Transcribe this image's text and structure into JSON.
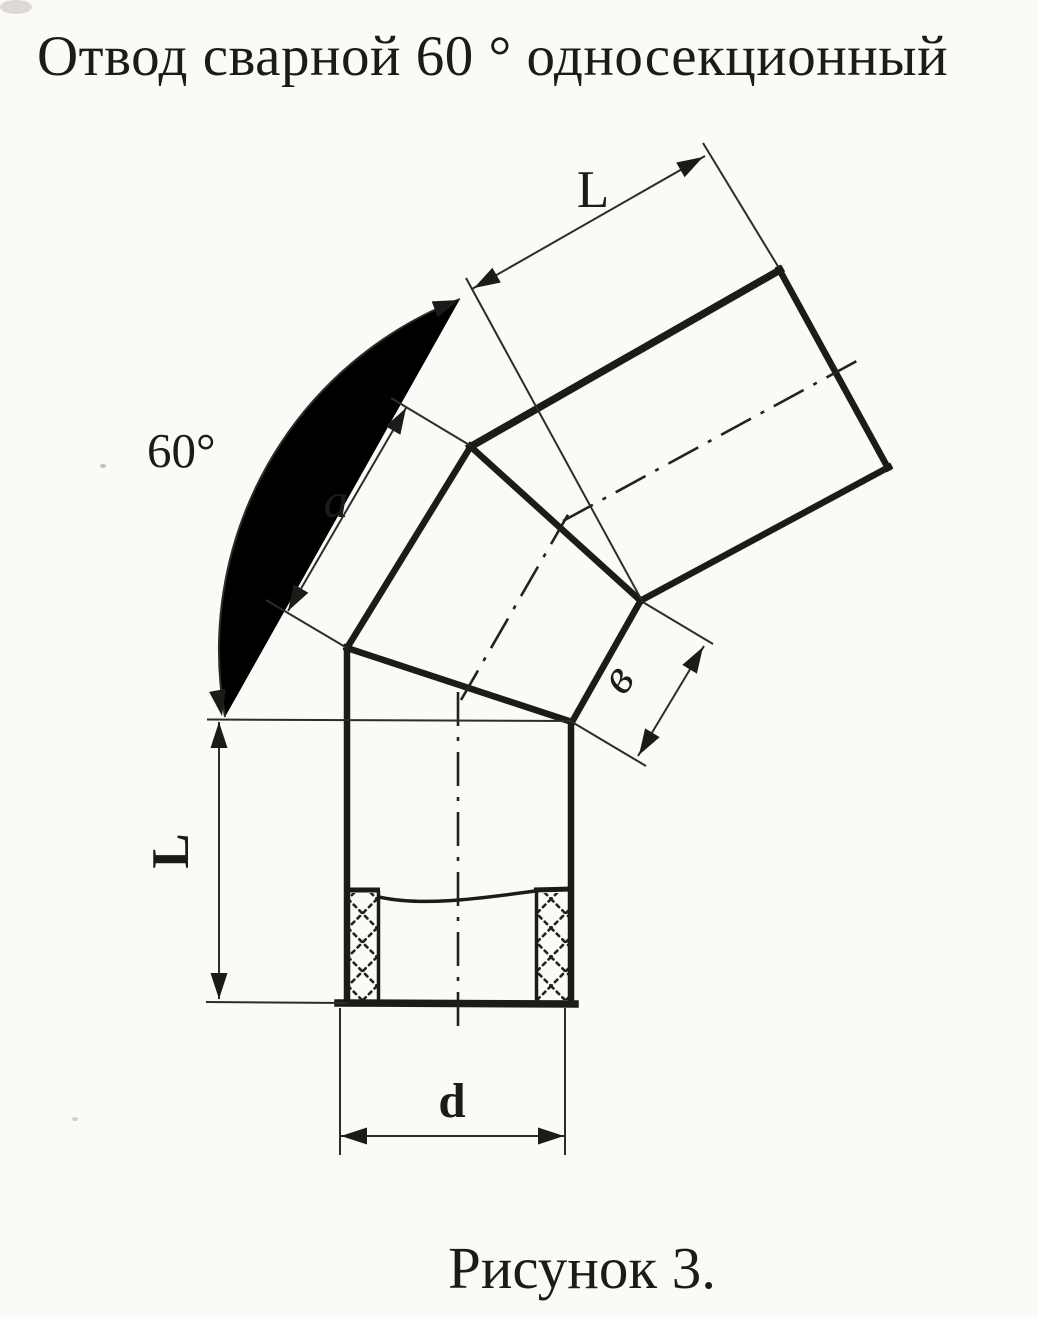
{
  "title": "Отвод сварной 60 ° односекционный",
  "caption": "Рисунок 3.",
  "colors": {
    "ink": "#1c1b19",
    "paper": "#fbfaf6"
  },
  "drawing": {
    "description": "Dimensioned technical sketch of a welded 60-degree single-section pipe elbow: a vertical lower pipe with socket hatching, one mitered middle section and an inclined upper pipe, with dash-dot centerlines",
    "labels": {
      "upper_pipe_length": "L",
      "bend_angle": "60°",
      "section_long_side": "a",
      "section_short_side": "в",
      "lower_pipe_length": "L",
      "bore_diameter": "d"
    }
  }
}
